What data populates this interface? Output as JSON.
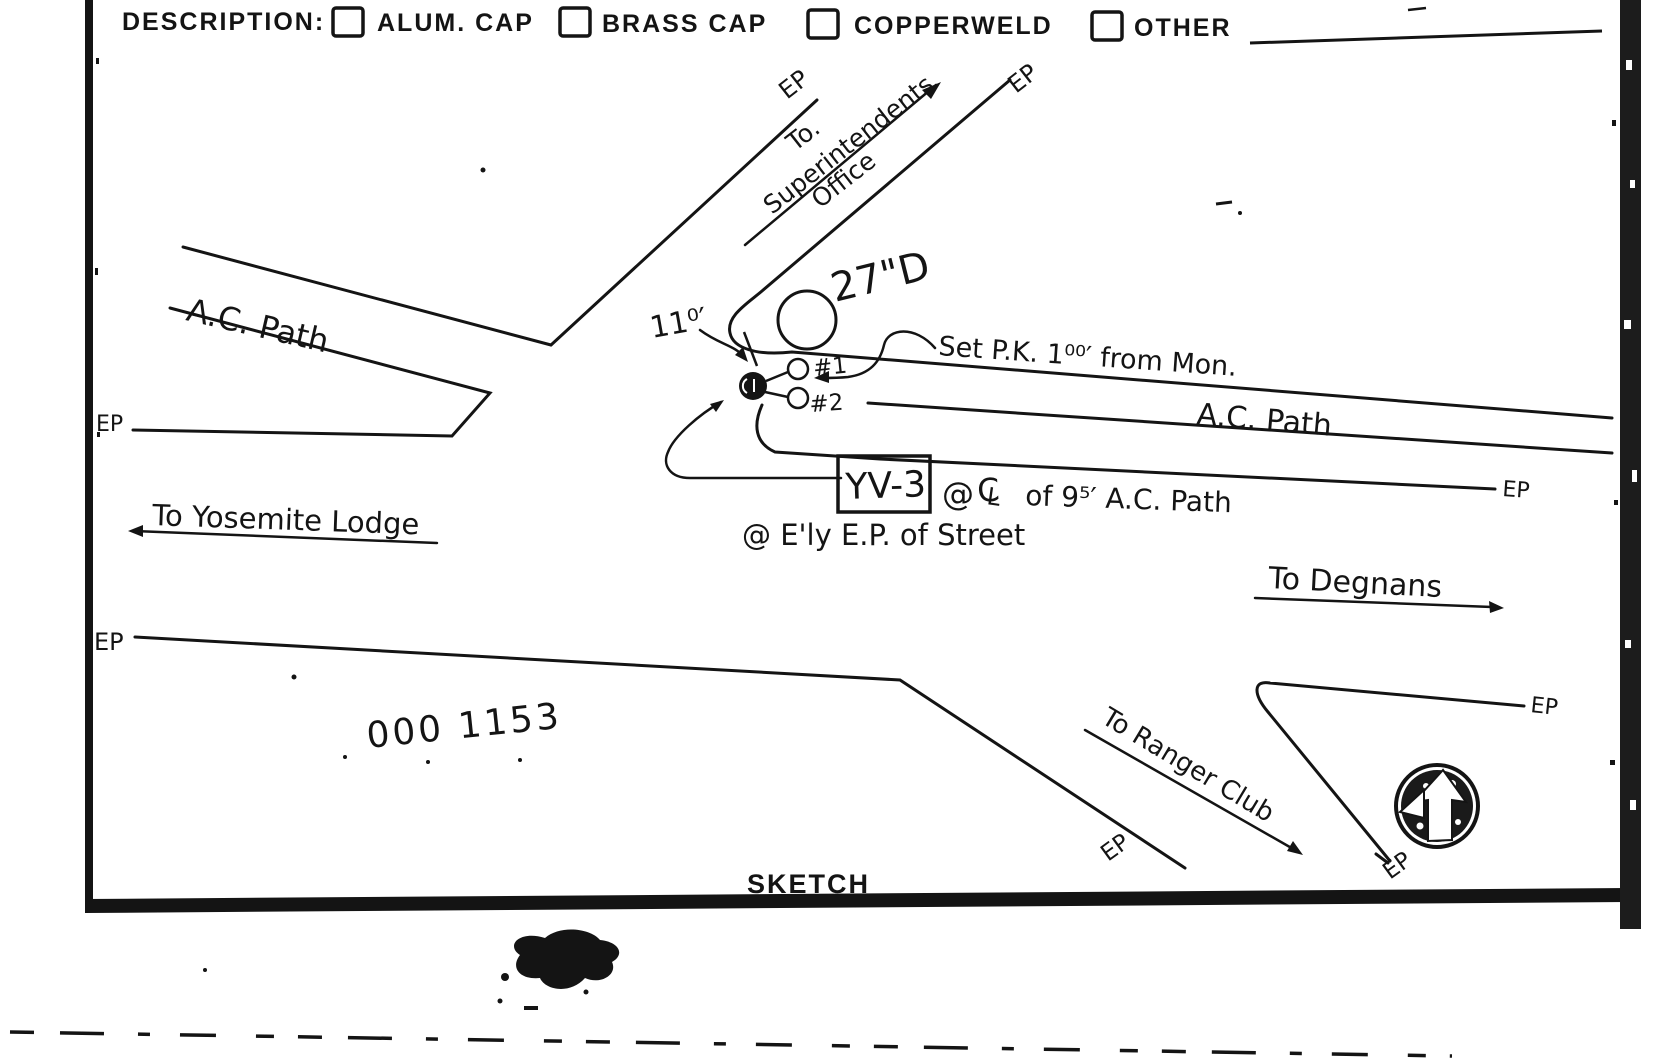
{
  "form": {
    "description_label": "DESCRIPTION:",
    "options": [
      {
        "label": "ALUM. CAP",
        "checked": false
      },
      {
        "label": "BRASS CAP",
        "checked": false
      },
      {
        "label": "COPPERWELD",
        "checked": false
      },
      {
        "label": "OTHER",
        "checked": false
      }
    ]
  },
  "sketch": {
    "title": "SKETCH",
    "ep_label": "EP",
    "road_to_superintendents": {
      "line1": "To.",
      "line2": "Superintendents",
      "line3": "Office"
    },
    "ac_path_left": "A.C. Path",
    "ac_path_right": "A.C. Path",
    "tree_label": "27\"D",
    "offset_label": "11⁰′",
    "pk_note": "Set P.K. 1⁰⁰′ from Mon.",
    "witness1": "#1",
    "witness2": "#2",
    "station": {
      "id": "YV-3",
      "note_at": "@",
      "note_cl_c": "C",
      "note_cl_l": "L",
      "note_rest": "of 9⁵′ A.C. Path",
      "note_line2": "@ E'ly E.P. of Street"
    },
    "to_yosemite_lodge": "To Yosemite Lodge",
    "to_degnans": "To Degnans",
    "to_ranger_club": "To Ranger Club",
    "handwritten_number": "000 1153"
  },
  "colors": {
    "ink": "#141414",
    "paper": "#ffffff"
  }
}
